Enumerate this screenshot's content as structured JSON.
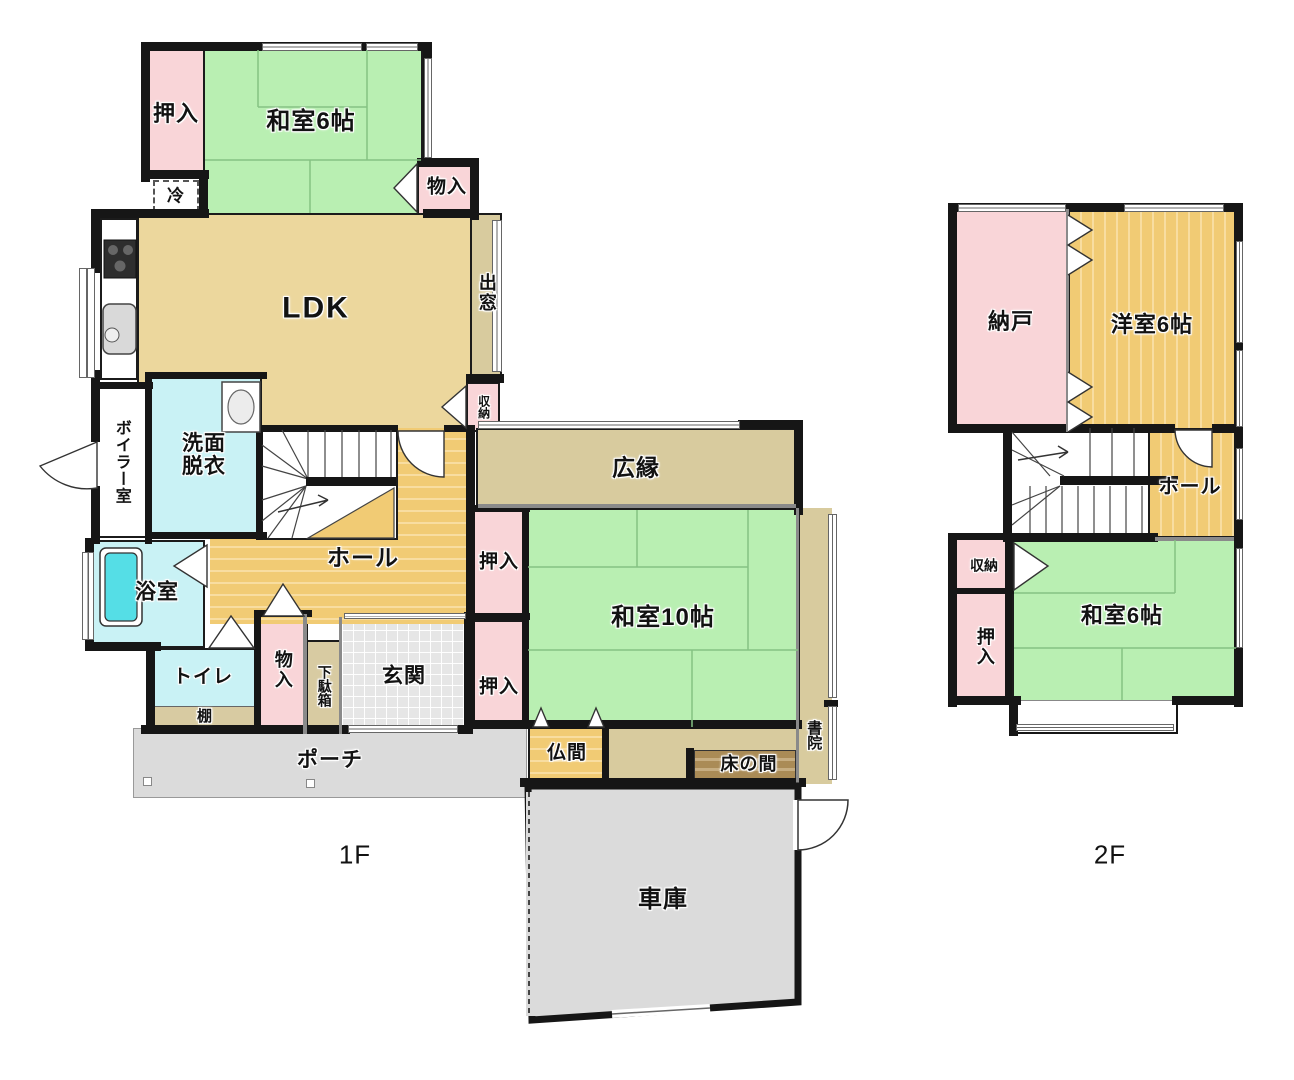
{
  "floor1": {
    "label": "1F",
    "rooms": {
      "oshiire_nw": "押入",
      "washitsu6": "和室6帖",
      "monoire_ne": "物入",
      "rei": "冷",
      "ldk": "LDK",
      "demado": "出窓",
      "shuno": "収納",
      "senmen": "洗面脱衣",
      "boiler": "ボイラー室",
      "yokushitsu": "浴室",
      "toire": "トイレ",
      "tana": "棚",
      "monoire_genkan": "物入",
      "getabako": "下駄箱",
      "genkan": "玄関",
      "hall": "ホール",
      "hiroen": "広縁",
      "oshiire_w_upper": "押入",
      "oshiire_w_lower": "押入",
      "washitsu10": "和室10帖",
      "butsuma": "仏間",
      "tokonoma": "床の間",
      "shoin": "書院",
      "porch": "ポーチ",
      "garage": "車庫"
    }
  },
  "floor2": {
    "label": "2F",
    "rooms": {
      "nando": "納戸",
      "yoshitsu6": "洋室6帖",
      "hall": "ホール",
      "shuno": "収納",
      "oshiire": "押入",
      "washitsu6": "和室6帖"
    }
  },
  "colors": {
    "wall": "#161616",
    "tatami_green": "#B9EFB2",
    "closet_pink": "#F9D5D8",
    "ldk_tan": "#ECD79D",
    "wood_floor": "#F1CB74",
    "hiroen_tan": "#D8CB9E",
    "wet_area_cyan": "#C9F2F5",
    "bathtub": "#55DEE6",
    "concrete_gray": "#DBDBDB",
    "tokonoma_brown": "#AA8B56"
  }
}
